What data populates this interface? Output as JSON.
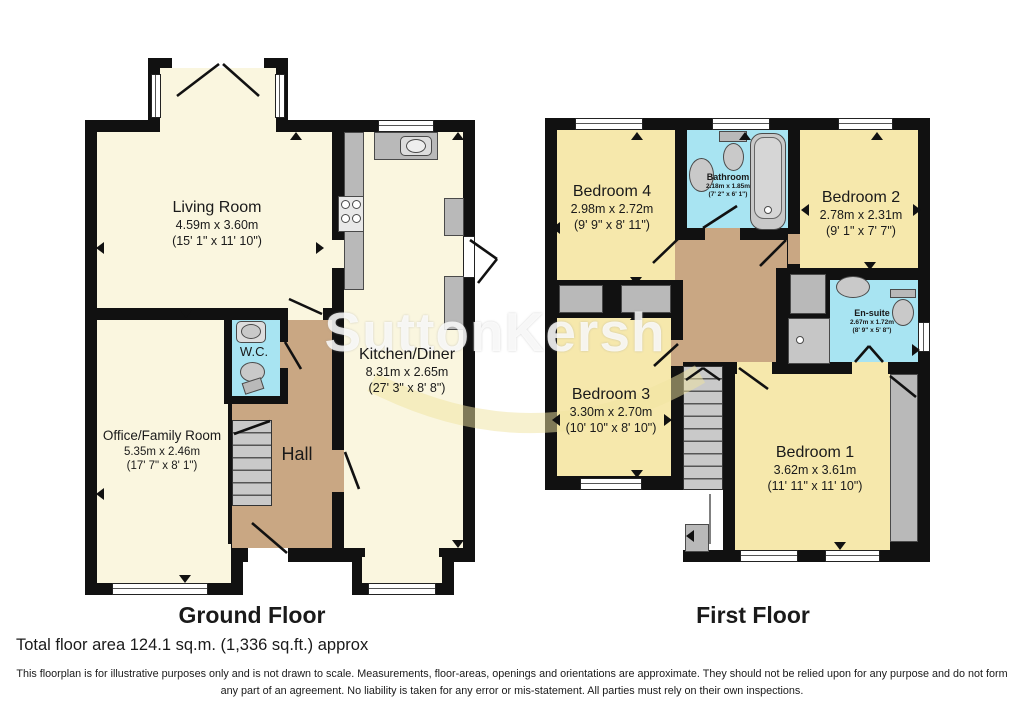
{
  "watermark": {
    "text": "SuttonKersh"
  },
  "footer": {
    "total_area": "Total floor area 124.1 sq.m. (1,336 sq.ft.) approx",
    "disclaimer": "This floorplan is for illustrative purposes only and is not drawn to scale. Measurements, floor-areas, openings and orientations are approximate. They should not be relied upon for any purpose and do not form any part of an agreement. No liability is taken for any error or mis-statement. All parties must rely on their own inspections."
  },
  "colors": {
    "wall": "#111111",
    "ground_room": "#FAF6DF",
    "first_room": "#F6E8AC",
    "hall_landing": "#C9A783",
    "wet_room": "#A8E4F2",
    "fixture_gray": "#B9B9B9"
  },
  "floors": [
    {
      "title": "Ground Floor",
      "rooms": [
        {
          "name": "Living Room",
          "metric": "4.59m x 3.60m",
          "imperial": "(15' 1\" x 11' 10\")"
        },
        {
          "name": "Kitchen/Diner",
          "metric": "8.31m x 2.65m",
          "imperial": "(27' 3\" x 8' 8\")"
        },
        {
          "name": "W.C.",
          "metric": "",
          "imperial": ""
        },
        {
          "name": "Hall",
          "metric": "",
          "imperial": ""
        },
        {
          "name": "Office/Family Room",
          "metric": "5.35m x 2.46m",
          "imperial": "(17' 7\" x 8' 1\")"
        }
      ]
    },
    {
      "title": "First Floor",
      "rooms": [
        {
          "name": "Bedroom 4",
          "metric": "2.98m x 2.72m",
          "imperial": "(9' 9\" x 8' 11\")"
        },
        {
          "name": "Bathroom",
          "metric": "2.18m x 1.85m",
          "imperial": "(7' 2\" x 6' 1\")"
        },
        {
          "name": "Bedroom 2",
          "metric": "2.78m x 2.31m",
          "imperial": "(9' 1\" x 7' 7\")"
        },
        {
          "name": "En-suite",
          "metric": "2.67m x 1.72m",
          "imperial": "(8' 9\" x 5' 8\")"
        },
        {
          "name": "Bedroom 3",
          "metric": "3.30m x 2.70m",
          "imperial": "(10' 10\" x 8' 10\")"
        },
        {
          "name": "Bedroom 1",
          "metric": "3.62m x 3.61m",
          "imperial": "(11' 11\" x 11' 10\")"
        }
      ]
    }
  ]
}
